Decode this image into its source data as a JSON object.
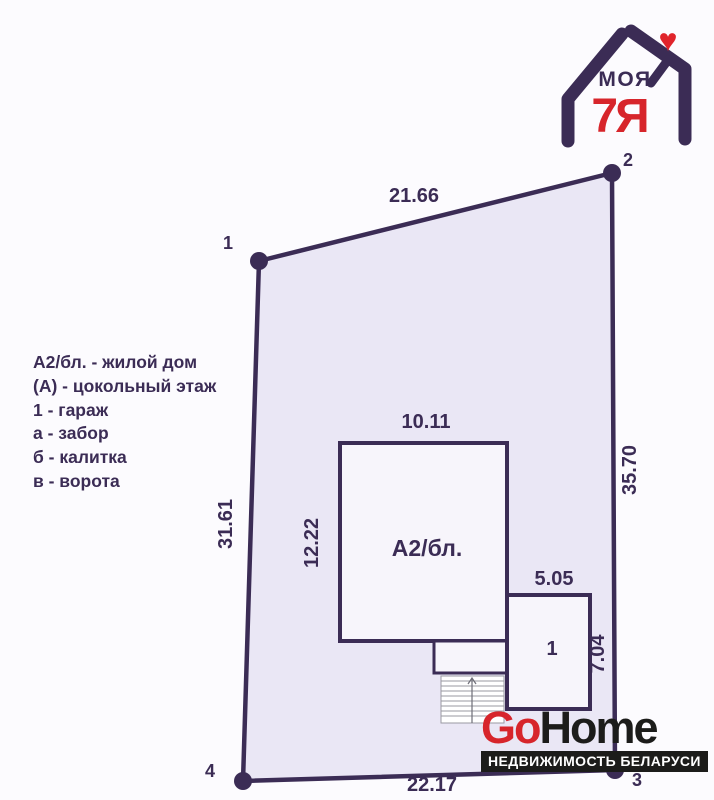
{
  "brand": {
    "moya": "МОЯ",
    "family": "7Я",
    "heart": "♥"
  },
  "legend": {
    "lines": [
      "А2/бл. - жилой дом",
      "(А) - цокольный этаж",
      "1 - гараж",
      "а - забор",
      "б - калитка",
      "в - ворота"
    ]
  },
  "plot": {
    "corners": [
      "1",
      "2",
      "3",
      "4"
    ],
    "dim_top": "21.66",
    "dim_right": "35.70",
    "dim_left": "31.61",
    "dim_bottom": "22.17"
  },
  "house": {
    "label": "А2/бл.",
    "dim_width": "10.11",
    "dim_depth": "12.22"
  },
  "garage": {
    "label": "1",
    "dim_width": "5.05",
    "dim_depth": "7.04"
  },
  "watermark": {
    "go": "Go",
    "home": "Home",
    "tagline": "НЕДВИЖИМОСТЬ БЕЛАРУСИ"
  },
  "colors": {
    "line": "#3b2c55",
    "plot_fill": "#eae7f5",
    "building_fill": "#f7f5fb",
    "accent_red": "#d7252b",
    "logo_black": "#1c1c1a"
  }
}
